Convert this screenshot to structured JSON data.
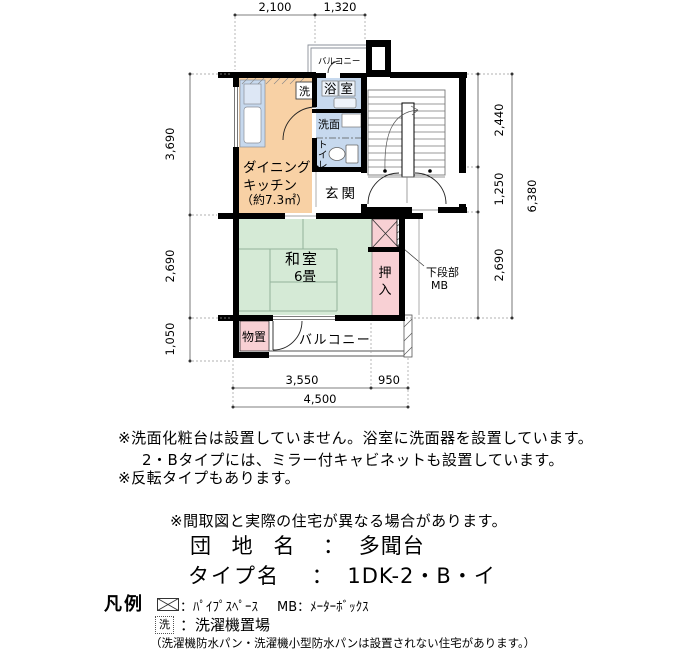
{
  "plan": {
    "dims": {
      "top_1": "2,100",
      "top_2": "1,320",
      "left_1": "3,690",
      "left_2": "2,690",
      "left_3": "1,050",
      "right_1": "2,440",
      "right_2": "1,250",
      "right_3": "2,690",
      "right_total": "6,380",
      "bottom_1": "3,550",
      "bottom_2": "950",
      "bottom_total": "4,500"
    },
    "rooms": {
      "dk_1": "ダイニング・",
      "dk_2": "キッチン",
      "dk_3": "（約7.3㎡）",
      "bath": "浴室",
      "washbasin": "洗面",
      "toilet_1": "ト",
      "toilet_2": "イ",
      "toilet_3": "レ",
      "entrance": "玄関",
      "washitsu": "和室",
      "washitsu_size": "6畳",
      "closet_1": "押",
      "closet_2": "入",
      "storage": "物置",
      "balcony": "バルコニー",
      "balcony_upper": "バルコニー",
      "laundry": "洗",
      "mb_note_1": "下段部",
      "mb_note_2": "MB"
    }
  },
  "notes": {
    "line1": "※洗面化粧台は設置していません。浴室に洗面器を設置しています。",
    "line2": "2・Bタイプには、ミラー付キャビネットも設置しています。",
    "line3": "※反転タイプもあります。",
    "disclaimer": "※間取図と実際の住宅が異なる場合があります。"
  },
  "property": {
    "estate_label": "団 地 名",
    "estate_colon": "：",
    "estate_name": "多聞台",
    "type_label": "タイプ名",
    "type_colon": "：",
    "type_name": "1DK-2・B・イ"
  },
  "legend": {
    "title": "凡例",
    "pipe_space_desc": "：ﾊﾟｲﾌﾟｽﾍﾟｰｽ",
    "mb_desc": "MB：ﾒｰﾀｰﾎﾞｯｸｽ",
    "laundry_symbol": "洗",
    "laundry_desc": "：洗濯機置場",
    "laundry_note": "（洗濯機防水パン・洗濯機小型防水パンは設置されない住宅があります。）"
  },
  "colors": {
    "dk_orange": "#F8D1A5",
    "water_blue": "#C7D9EE",
    "tatami_green": "#D5EAD6",
    "closet_pink": "#F8D0D4",
    "wall_black": "#000000"
  }
}
